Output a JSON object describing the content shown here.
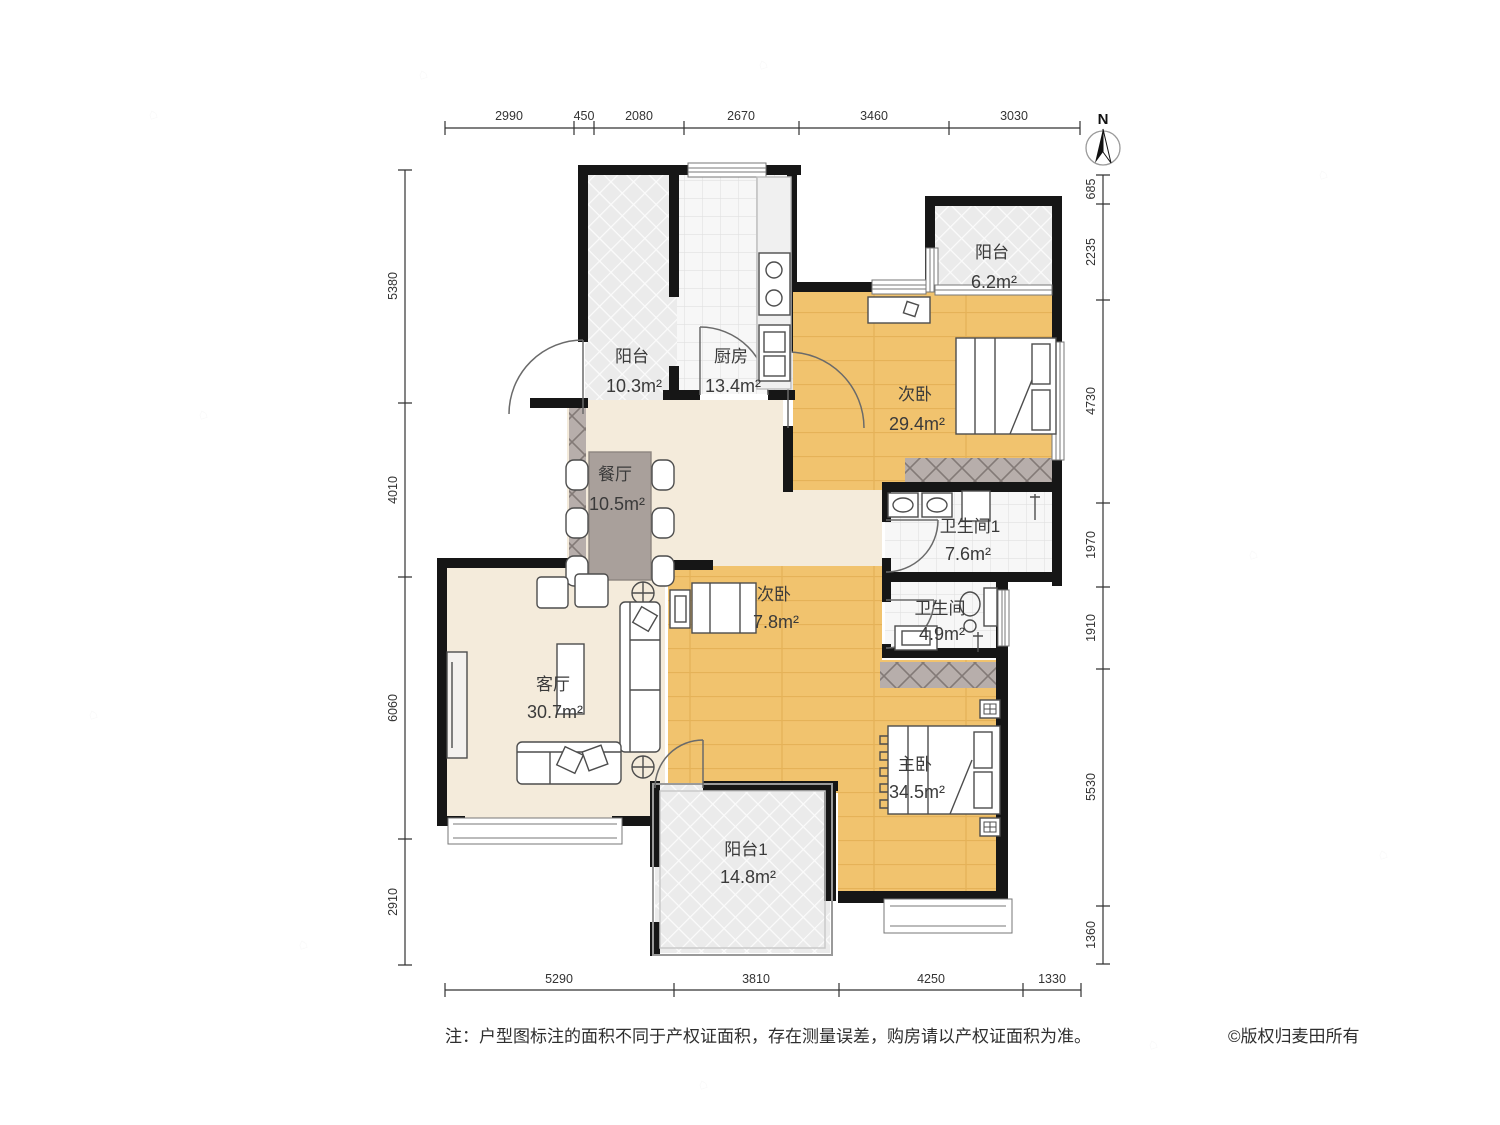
{
  "compass": {
    "label": "N"
  },
  "rooms": {
    "balcony_tl": {
      "name": "阳台",
      "area": "10.3m²"
    },
    "kitchen": {
      "name": "厨房",
      "area": "13.4m²"
    },
    "balcony_tr": {
      "name": "阳台",
      "area": "6.2m²"
    },
    "bedroom2_large": {
      "name": "次卧",
      "area": "29.4m²"
    },
    "dining": {
      "name": "餐厅",
      "area": "10.5m²"
    },
    "bath1": {
      "name": "卫生间1",
      "area": "7.6m²"
    },
    "bath2": {
      "name": "卫生间",
      "area": "4.9m²"
    },
    "bedroom2_small": {
      "name": "次卧",
      "area": "7.8m²"
    },
    "living": {
      "name": "客厅",
      "area": "30.7m²"
    },
    "master": {
      "name": "主卧",
      "area": "34.5m²"
    },
    "balcony1": {
      "name": "阳台1",
      "area": "14.8m²"
    }
  },
  "dimensions": {
    "top": [
      "2990",
      "450",
      "2080",
      "2670",
      "3460",
      "3030"
    ],
    "bottom": [
      "5290",
      "3810",
      "4250",
      "1330"
    ],
    "left": [
      "5380",
      "4010",
      "6060",
      "2910"
    ],
    "right": [
      "685",
      "2235",
      "4730",
      "1970",
      "1910",
      "5530",
      "1360"
    ]
  },
  "footer": {
    "note": "注：户型图标注的面积不同于产权证面积，存在测量误差，购房请以产权证面积为准。",
    "copyright": "©版权归麦田所有"
  },
  "colors": {
    "wall": "#161616",
    "wood_floor": "#F1C36E",
    "cream_floor": "#F4EBDB",
    "balcony_fill": "#EBEBEB",
    "tile_fill": "#F7F7F7",
    "wardrobe_fill": "#B7AEAB"
  }
}
